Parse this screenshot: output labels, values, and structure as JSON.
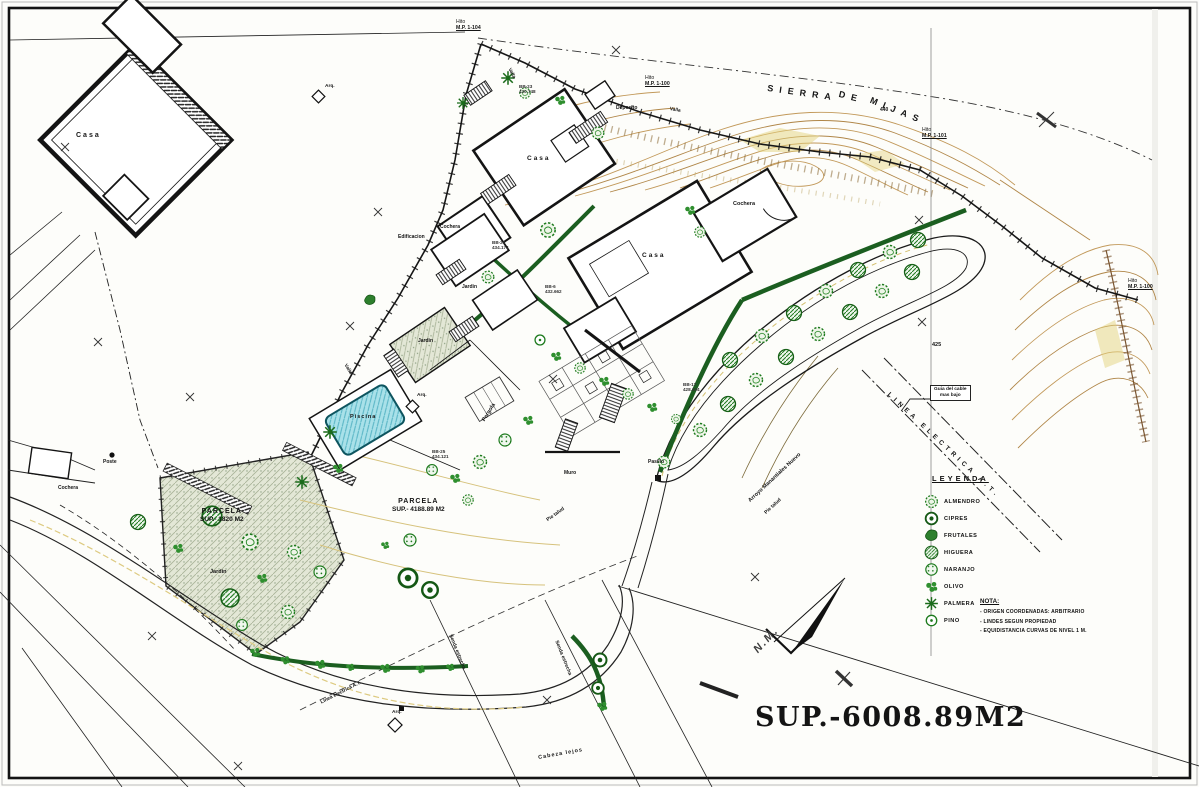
{
  "plan": {
    "region_title": {
      "part1": "SIERRA",
      "part2": "DE",
      "part3": "MIJAS"
    },
    "total_area": "SUP.-6008.89M2",
    "north_label": "N.M."
  },
  "buildings": {
    "casa": "Casa",
    "cochera": "Cochera",
    "deposito": "Deposito",
    "edificacion": "Edificacion"
  },
  "site": {
    "jardin": "Jardin",
    "piscina": "Piscina",
    "pergola": "Pergola",
    "muro": "Muro",
    "pasillo": "Pasillo",
    "poste": "Poste",
    "arqueta": "Arq.",
    "valla": "Valla"
  },
  "parcels": [
    {
      "title": "PARCELA",
      "area": "SUP.- 1820 M2"
    },
    {
      "title": "PARCELA",
      "area": "SUP.- 4188.89 M2"
    }
  ],
  "markers": {
    "hito": "Hito",
    "refs": [
      "M.P. 1-104",
      "M.P. 1-100",
      "M.P. 1-101",
      "M.P. 1-100"
    ]
  },
  "lines": {
    "power": "LINEA ELECTRICA A.T.",
    "power_small": "Linea electrica A.T.",
    "cable_note_1": "Guia del cable",
    "cable_note_2": "mas bajo",
    "stream": "Arroyo Manantiales Nuevo",
    "slope": "Pie talud",
    "path": "Senda estrecha",
    "road": "Cabeza lejos"
  },
  "elevations": [
    "440",
    "425"
  ],
  "stations": [
    {
      "id": "BB-6",
      "z": "432.662"
    },
    {
      "id": "BB-20",
      "z": "434.174"
    },
    {
      "id": "BB-17",
      "z": "428.004"
    },
    {
      "id": "BB-23",
      "z": "430.748"
    },
    {
      "id": "BB-25",
      "z": "434.121"
    }
  ],
  "legend": {
    "title": "LEYENDA",
    "items": [
      {
        "icon": "almendro-icon",
        "label": "ALMENDRO"
      },
      {
        "icon": "cipres-icon",
        "label": "CIPRES"
      },
      {
        "icon": "frutales-icon",
        "label": "FRUTALES"
      },
      {
        "icon": "higuera-icon",
        "label": "HIGUERA"
      },
      {
        "icon": "naranjo-icon",
        "label": "NARANJO"
      },
      {
        "icon": "olivo-icon",
        "label": "OLIVO"
      },
      {
        "icon": "palmera-icon",
        "label": "PALMERA"
      },
      {
        "icon": "pino-icon",
        "label": "PINO"
      }
    ]
  },
  "nota": {
    "title": "NOTA:",
    "items": [
      "- ORIGEN COORDENADAS: ARBITRARIO",
      "- LINDES SEGUN PROPIEDAD",
      "- EQUIDISTANCIA CURVAS DE NIVEL 1 M."
    ]
  },
  "colors": {
    "ink": "#1a1a1a",
    "tree_green": "#1e7a1e",
    "hedge_green": "#1b5e20",
    "contour_tan": "#c2995a",
    "pool_blue": "#9fdbe4",
    "garden_fill": "#e3e7d6"
  }
}
